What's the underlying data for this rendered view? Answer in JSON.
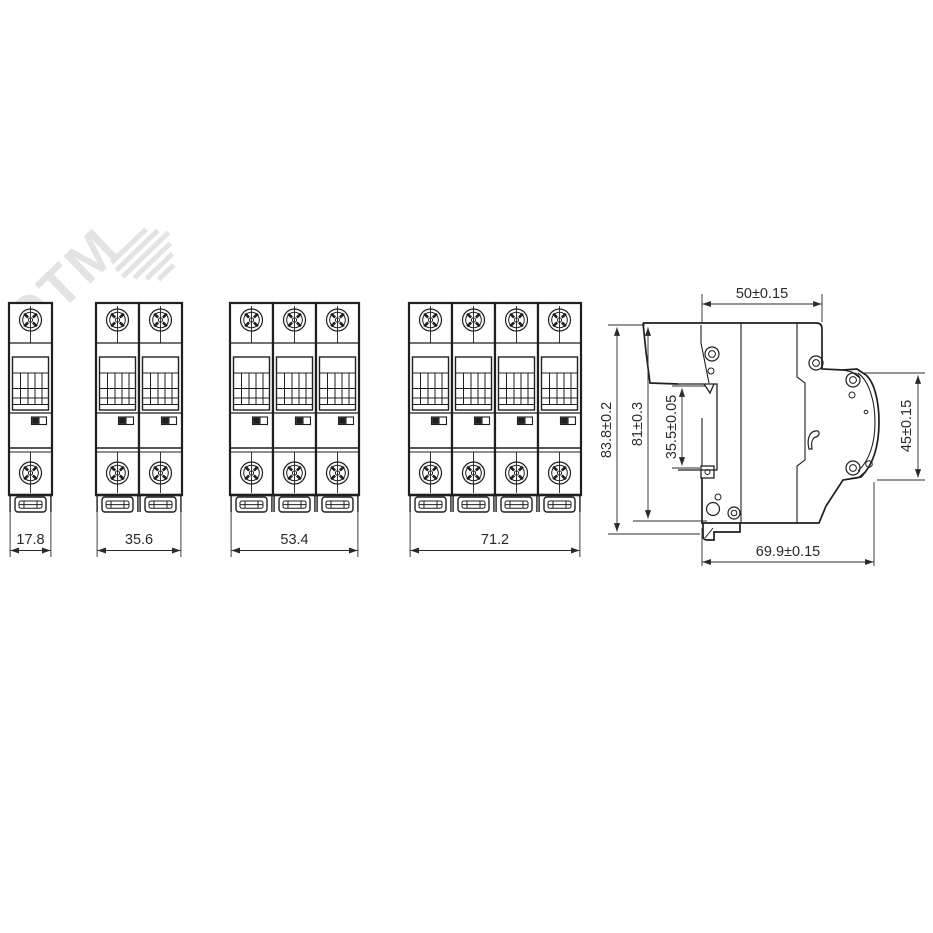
{
  "watermark": {
    "text": "ЭТМ"
  },
  "front_views": {
    "pole1": {
      "width": "17.8"
    },
    "pole2": {
      "width": "35.6"
    },
    "pole3": {
      "width": "53.4"
    },
    "pole4": {
      "width": "71.2"
    }
  },
  "side_view": {
    "dim_top_depth": "50±0.15",
    "dim_overall_height": "83.8±0.2",
    "dim_body_height": "81±0.3",
    "dim_din_slot": "35.5±0.05",
    "dim_front_height": "45±0.15",
    "dim_overall_depth": "69.9±0.15"
  },
  "colors": {
    "line": "#1f1f1f",
    "dim": "#2a2a2a",
    "watermark": "#e3e3e3",
    "background": "#ffffff"
  }
}
